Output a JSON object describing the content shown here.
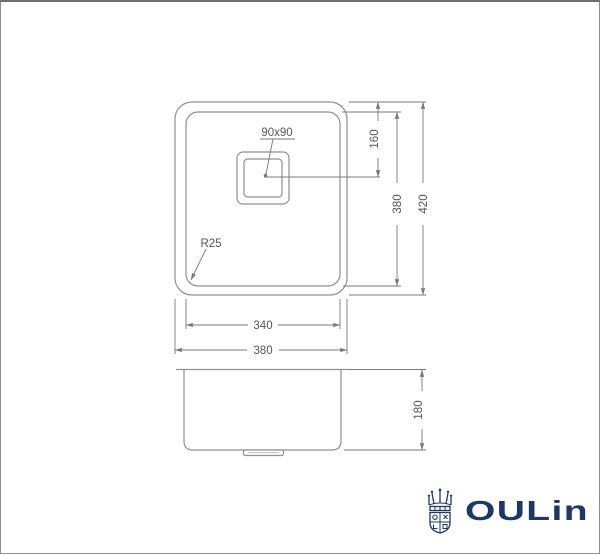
{
  "window": {
    "border_color": "#8d8d8d"
  },
  "drawing": {
    "line_color": "#909090",
    "dim_color": "#7a7a7a",
    "text_color": "#565656",
    "top_view": {
      "drain_size_label": "90x90",
      "corner_radius_label": "R25",
      "dim_drain_center": "160",
      "dim_inner_length": "380",
      "dim_outer_length": "420",
      "dim_inner_width": "340",
      "dim_outer_width": "380"
    },
    "side_view": {
      "dim_depth": "180"
    }
  },
  "brand": {
    "name": "OULin",
    "color": "#1d3768"
  }
}
